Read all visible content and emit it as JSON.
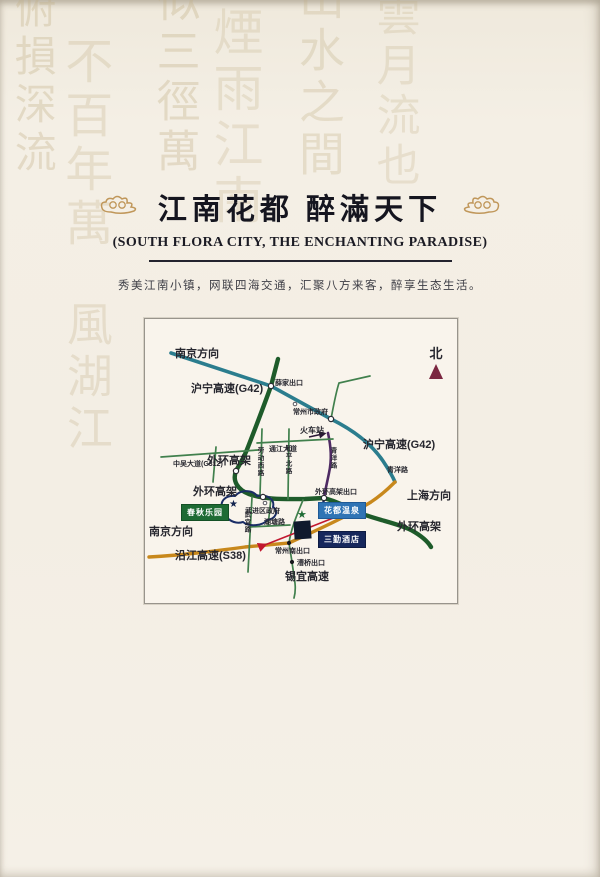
{
  "page": {
    "title": "江南花都 醉滿天下",
    "subtitle": "(SOUTH FLORA CITY, THE ENCHANTING PARADISE)",
    "tagline": "秀美江南小镇，网联四海交通，汇聚八方来客，醉享生态生活。"
  },
  "watermark": {
    "c1": "俯損深流",
    "c2": "不百年萬",
    "c3": "似三徑萬",
    "c4": "煙雨江南",
    "c5": "山水之間",
    "c6": "雲月流也",
    "c7": "風湖江"
  },
  "map": {
    "colors": {
      "g42_teal": "#2b7d8e",
      "ring_green": "#1e5b2a",
      "local_green": "#41804d",
      "s38_orange": "#c8881c",
      "qingyang_purple": "#4e2a63",
      "arrow_red": "#c2182f",
      "park_navy": "#1a2d66",
      "north_maroon": "#7b2640"
    },
    "labels": {
      "nanjing_top": "南京方向",
      "huning_left": "沪宁高速(G42)",
      "xuejia_exit": "薛家出口",
      "czgov": "常州市政府",
      "train_station": "火车站",
      "tongjiang": "通江大道",
      "huning_right": "沪宁高速(G42)",
      "waihuan_upper_left": "外环高架",
      "zhongwu": "中吴大道(G312)",
      "laodong": "劳动西路",
      "heping": "和平北路",
      "qingyang_vertical": "青洋路",
      "qingyang_right": "青洋路",
      "shanghai": "上海方向",
      "waihuan_lower_left": "外环高架",
      "waihuan_exit": "外环高架出口",
      "wujin_gov": "武进区政府",
      "hutang": "湖塘路",
      "wuyi": "武宜路",
      "waihuan_right": "外环高架",
      "nanjing_bottom": "南京方向",
      "yanjiang": "沿江高速(S38)",
      "cz_south_exit": "常州南出口",
      "caoqiao_exit": "漕桥出口",
      "xiyi": "锡宜高速",
      "north": "北"
    },
    "badges": {
      "park": "春秋乐园",
      "spa": "花都温泉",
      "hotel": "三勤酒店"
    },
    "stars": {
      "park_star": "★",
      "spa_star": "★"
    }
  }
}
